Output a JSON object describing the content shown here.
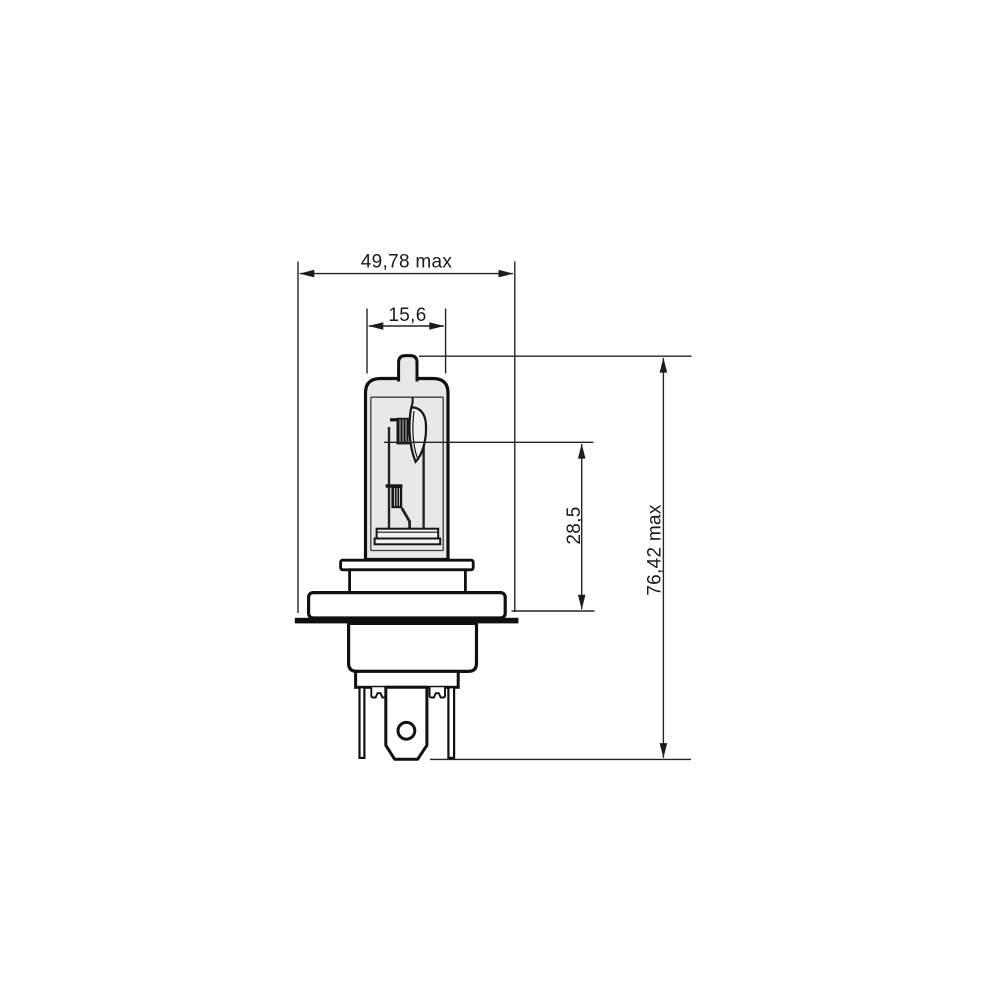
{
  "page": {
    "background": "#ffffff"
  },
  "drawing": {
    "kind": "technical dimension drawing",
    "subject": "H4 halogen headlamp bulb, side cross-section",
    "stroke_color": "#242424",
    "outline_color": "#101010",
    "glass_fill": "#e6eae6",
    "shield_fill": "#eef1ee",
    "filament_fill": "#161616",
    "dimensions": {
      "overall_width": {
        "label": "49,78 max",
        "value": 49.78,
        "qualifier": "max",
        "orientation": "horizontal"
      },
      "bulb_diameter": {
        "label": "15,6",
        "value": 15.6,
        "qualifier": "",
        "orientation": "horizontal"
      },
      "filament_to_flange": {
        "label": "28,5",
        "value": 28.5,
        "qualifier": "",
        "orientation": "vertical"
      },
      "overall_length": {
        "label": "76,42 max",
        "value": 76.42,
        "qualifier": "max",
        "orientation": "vertical"
      }
    }
  }
}
